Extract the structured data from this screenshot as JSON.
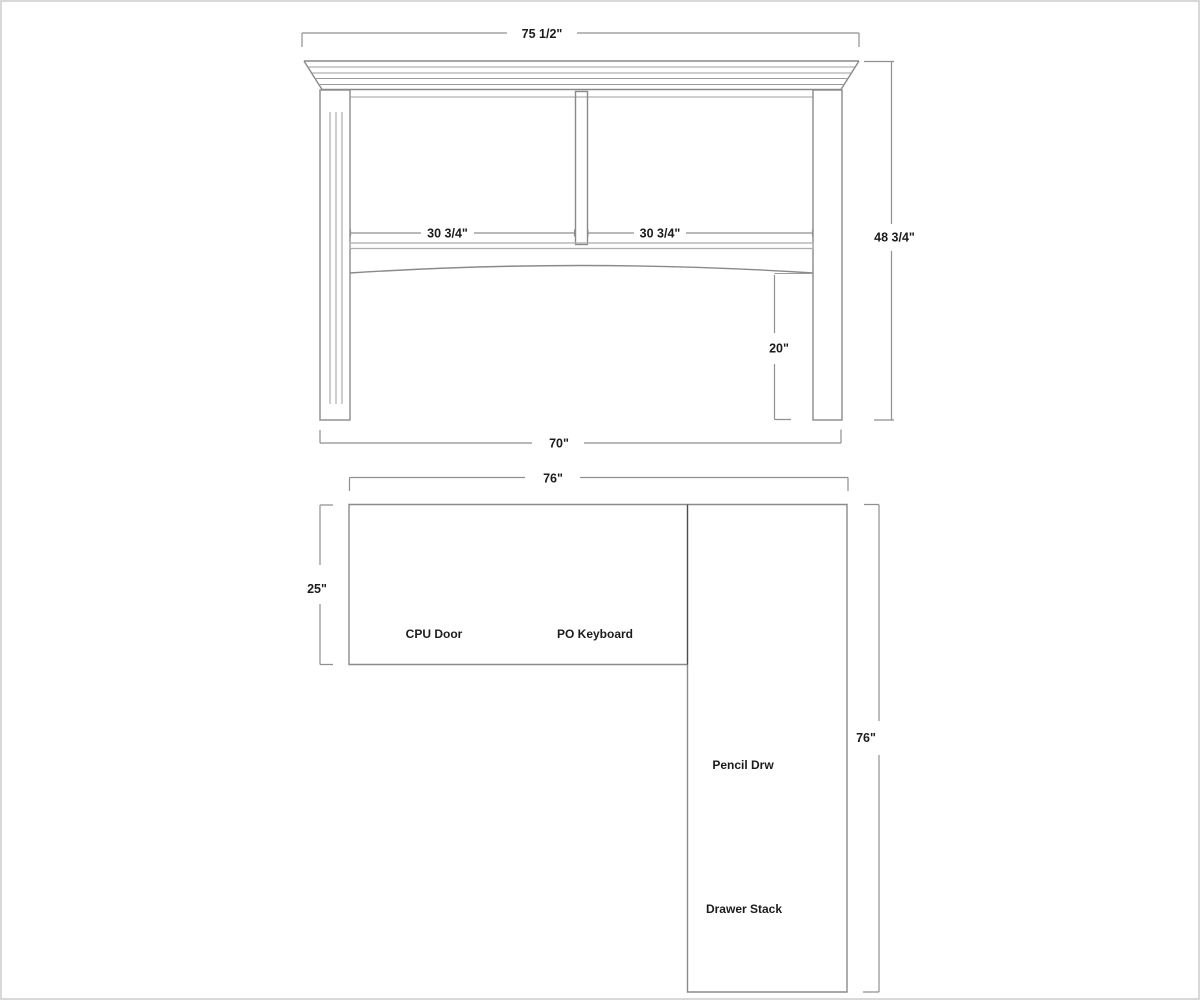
{
  "colors": {
    "background": "#ffffff",
    "border_color": "#d9d9d9",
    "object_line": "#8a8a8a",
    "light_line": "#9c9c9c",
    "shelf_line": "#aeaeae",
    "divider_line": "#4d4d4d",
    "dim_line": "#8f8f8f",
    "text_color": "#1c1c1c"
  },
  "elevation": {
    "dim_overall_width": "75 1/2\"",
    "dim_left_opening": "30 3/4\"",
    "dim_right_opening": "30 3/4\"",
    "dim_overall_height": "48 3/4\"",
    "dim_knee_clearance": "20\"",
    "dim_base_width": "70\""
  },
  "plan": {
    "dim_top_width": "76\"",
    "dim_return_depth": "25\"",
    "dim_right_length": "76\"",
    "label_cpu_door": "CPU Door",
    "label_po_keyboard": "PO Keyboard",
    "label_pencil_drawer": "Pencil Drw",
    "label_drawer_stack": "Drawer Stack"
  }
}
